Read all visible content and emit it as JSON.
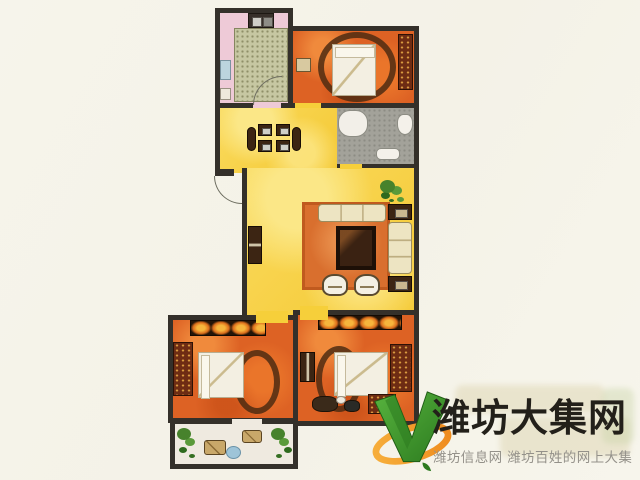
{
  "colors": {
    "bg": "#f5f3ea",
    "wall": "#34302a",
    "kitchen_floor": "#eecad7",
    "kitchen_tile": "#c6c7a2",
    "bedroom_floor": "#dd6224",
    "bath_floor": "#a3a29a",
    "living_floor": "#f6cf3a",
    "living_floor_light": "#fbe787",
    "balcony_floor": "#efeae0",
    "rug": "#d96f2e",
    "sofa_cream": "#ede4c2",
    "wood_dark": "#3c2513",
    "plant_green": "#47822c",
    "bed_white": "#f3efe2",
    "logo_green": "#3f9e2f",
    "logo_green_dark": "#2c7a1f",
    "logo_orange": "#f2982e",
    "brand_ink": "#23201a",
    "tagline_gray": "#94918a",
    "ghost_tan": "#d9cfa6"
  },
  "watermark": {
    "brand": "潍坊大集网",
    "tagline": "潍坊信息网 潍坊百姓的网上大集",
    "logo_icon": "v-checkmark-with-orange-swoosh"
  },
  "floorplan": {
    "type": "apartment-floor-plan",
    "rooms": [
      {
        "name": "kitchen",
        "floor": "pink",
        "features": [
          "stove-counter",
          "tiled-work-area",
          "door-arc"
        ]
      },
      {
        "name": "bedroom-north",
        "floor": "orange",
        "features": [
          "double-bed",
          "nightstand",
          "dresser"
        ]
      },
      {
        "name": "bathroom",
        "floor": "gray-tile",
        "features": [
          "bathtub",
          "toilet",
          "sink"
        ]
      },
      {
        "name": "dining-room",
        "floor": "yellow",
        "features": [
          "dining-table",
          "four-chairs",
          "entry-door-arc"
        ]
      },
      {
        "name": "living-room",
        "floor": "yellow",
        "features": [
          "sofa-set",
          "coffee-table",
          "area-rug",
          "side-tables",
          "armchairs",
          "cabinet",
          "potted-plant"
        ]
      },
      {
        "name": "bedroom-southwest",
        "floor": "orange",
        "features": [
          "double-bed",
          "wardrobe",
          "dresser"
        ]
      },
      {
        "name": "bedroom-southeast",
        "floor": "orange",
        "features": [
          "double-bed",
          "wardrobe",
          "dresser",
          "nightstand",
          "bags"
        ]
      },
      {
        "name": "balcony",
        "floor": "white",
        "features": [
          "potted-plants",
          "floor-cushions",
          "tea-table"
        ]
      }
    ]
  }
}
